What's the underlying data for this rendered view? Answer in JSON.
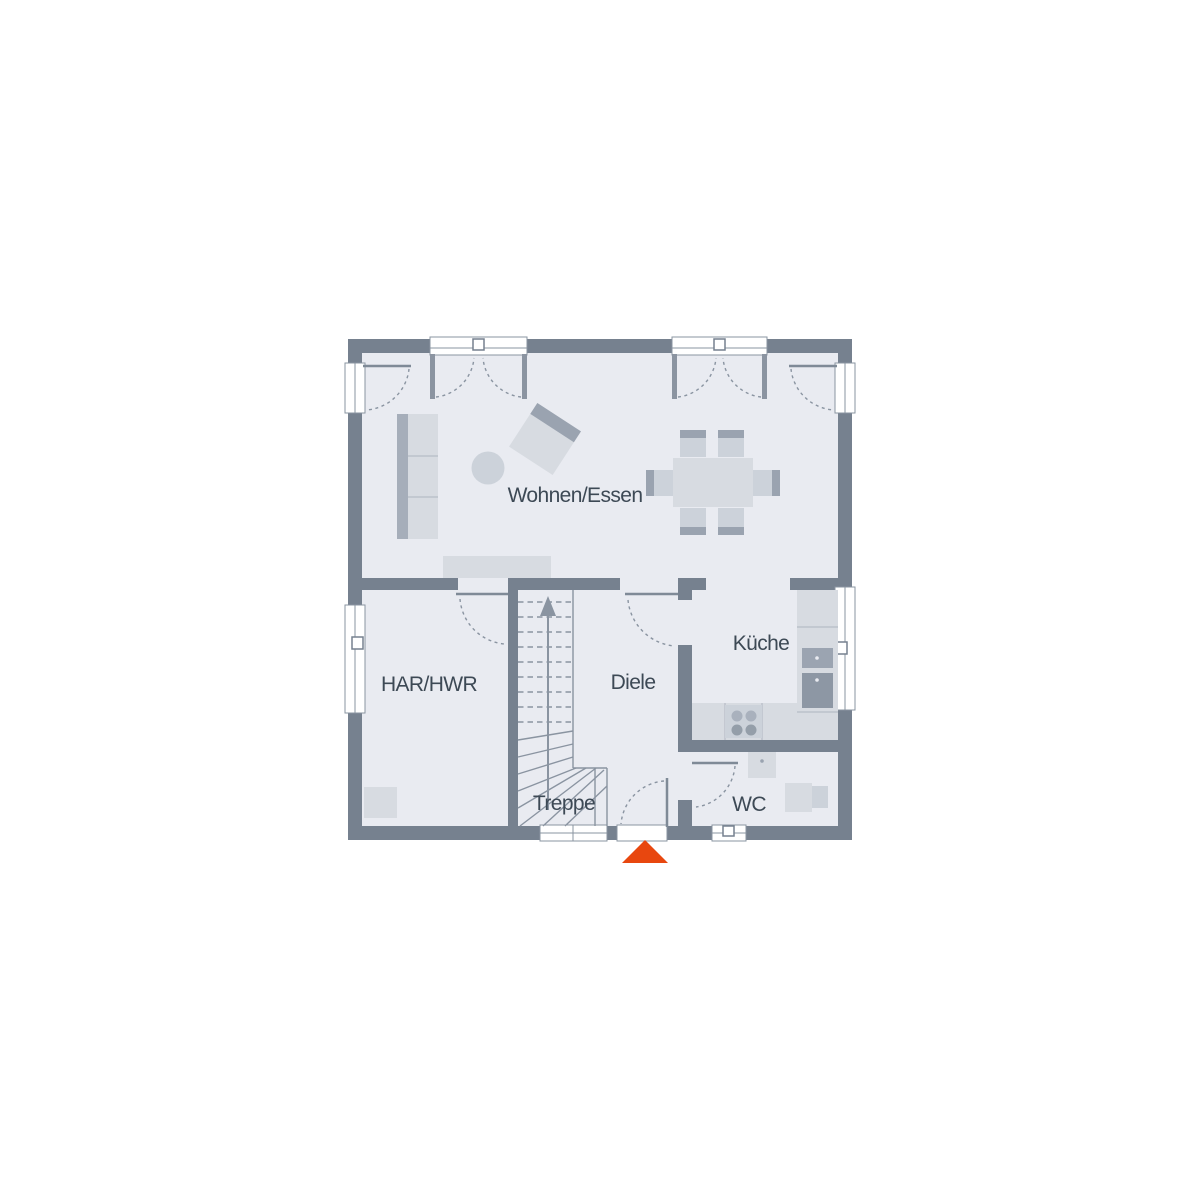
{
  "floorplan": {
    "title": "Erdgeschoss Grundriss",
    "rooms": [
      {
        "id": "wohnen-essen",
        "label": "Wohnen/Essen"
      },
      {
        "id": "har-hwr",
        "label": "HAR/HWR"
      },
      {
        "id": "diele",
        "label": "Diele"
      },
      {
        "id": "kueche",
        "label": "Küche"
      },
      {
        "id": "treppe",
        "label": "Treppe"
      },
      {
        "id": "wc",
        "label": "WC"
      }
    ],
    "entrance": {
      "marker": "entrance-arrow-triangle",
      "color": "#E8470F"
    },
    "icons": [
      "sofa",
      "coffee-table-round",
      "armchair",
      "sideboard",
      "dining-table",
      "dining-chair",
      "stairs-up-arrow",
      "kitchen-tall-unit",
      "microwave",
      "oven",
      "cooktop-burners",
      "kitchen-counter",
      "wc-sink",
      "wc-toilet",
      "utility-appliance",
      "french-door",
      "terrace-door",
      "window",
      "entrance-door",
      "interior-door"
    ],
    "colors": {
      "wall": "#76818F",
      "floor": "#E9EBF1",
      "furniture_light": "#D7DBE1",
      "furniture_mid": "#CCD2DA",
      "furniture_accent": "#9AA3B0",
      "line": "#8A94A1",
      "door_leaf": "#7F8A97",
      "label_text": "#3D4955",
      "entrance_marker": "#E8470F",
      "background": "#FFFFFF"
    }
  }
}
